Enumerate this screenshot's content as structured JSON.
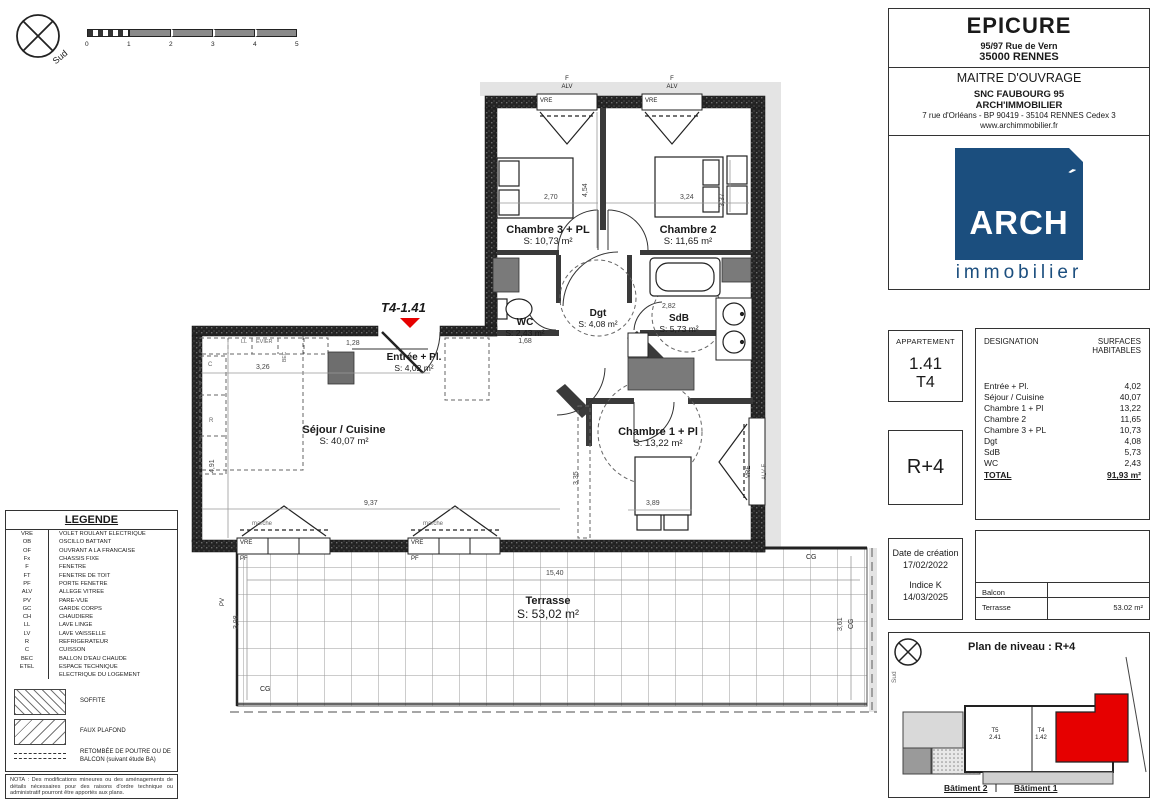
{
  "compass": {
    "label": "Sud"
  },
  "scalebar": {
    "ticks": [
      "0",
      "1",
      "2",
      "3",
      "4",
      "5"
    ]
  },
  "plan": {
    "unit_label": "T4-1.41",
    "rooms": {
      "ch3": {
        "name": "Chambre 3 + PL",
        "area": "S: 10,73 m²"
      },
      "ch2": {
        "name": "Chambre 2",
        "area": "S: 11,65 m²"
      },
      "wc": {
        "name": "WC",
        "area": "S: 2,43 m²"
      },
      "dgt": {
        "name": "Dgt",
        "area": "S: 4,08 m²"
      },
      "sdb": {
        "name": "SdB",
        "area": "S: 5,73 m²"
      },
      "entree": {
        "name": "Entrée + Pl.",
        "area": "S: 4,02 m²"
      },
      "sejour": {
        "name": "Séjour / Cuisine",
        "area": "S: 40,07 m²"
      },
      "ch1": {
        "name": "Chambre 1 + Pl",
        "area": "S: 13,22 m²"
      },
      "terrasse": {
        "name": "Terrasse",
        "area": "S: 53,02 m²"
      }
    },
    "dims": {
      "ch3_w": "2,70",
      "ch2_w": "3,24",
      "mid_h": "4,54",
      "ch2_h": "3,37",
      "entry_w": "1,28",
      "kitchen_w": "3,26",
      "sejour_h": "4,91",
      "sejour_w": "9,37",
      "wc_w": "1,68",
      "sdb_w": "2,82",
      "ch1_w": "3,89",
      "ch1_h": "3,35",
      "terr_w": "15,40",
      "terr_h": "3,98",
      "terr_r": "3,61"
    },
    "labels": {
      "f": "F",
      "alv": "ALV",
      "vre": "VRE",
      "pf": "PF",
      "pv": "PV",
      "cg": "CG",
      "marche": "marche",
      "ll": "LL",
      "evier": "EVIER",
      "c": "C",
      "r": "R",
      "bec": "BEC",
      "alv_f": "ALV  F"
    }
  },
  "title_block": {
    "project": {
      "name": "EPICURE",
      "address1": "95/97  Rue de Vern",
      "address2": "35000  RENNES"
    },
    "owner": {
      "title": "MAITRE D'OUVRAGE",
      "line1": "SNC FAUBOURG 95",
      "line2": "ARCH'IMMOBILIER",
      "line3": "7 rue d'Orléans - BP 90419 - 35104  RENNES Cedex 3",
      "line4": "www.archimmobilier.fr"
    },
    "logo": {
      "main": "ARCH",
      "accent": "´",
      "sub": "immobilier",
      "color": "#1b4e7e"
    },
    "apartment": {
      "label": "APPARTEMENT",
      "number": "1.41",
      "type": "T4"
    },
    "level": "R+4",
    "surfaces": {
      "col1": "DESIGNATION",
      "col2": "SURFACES HABITABLES",
      "rows": [
        {
          "label": "Entrée + Pl.",
          "value": "4,02"
        },
        {
          "label": "Séjour / Cuisine",
          "value": "40,07"
        },
        {
          "label": "Chambre 1 + Pl",
          "value": "13,22"
        },
        {
          "label": "Chambre 2",
          "value": "11,65"
        },
        {
          "label": "Chambre 3 + PL",
          "value": "10,73"
        },
        {
          "label": "Dgt",
          "value": "4,08"
        },
        {
          "label": "SdB",
          "value": "5,73"
        },
        {
          "label": "WC",
          "value": "2,43"
        }
      ],
      "total_label": "TOTAL",
      "total_value": "91,93 m²"
    },
    "dates": {
      "created_label": "Date de création",
      "created": "17/02/2022",
      "indice_label": "Indice K",
      "indice_date": "14/03/2025"
    },
    "exterior": {
      "balcon_label": "Balcon",
      "balcon_value": "",
      "terrasse_label": "Terrasse",
      "terrasse_value": "53.02 m²"
    }
  },
  "site_plan": {
    "title": "Plan de niveau : R+4",
    "compass_label": "Sud",
    "unit_t5": "T5",
    "unit_t5_num": "2.41",
    "unit_t4": "T4",
    "unit_t4_num": "1.42",
    "building2": "Bâtiment 2",
    "building1": "Bâtiment 1",
    "highlight_color": "#e60000"
  },
  "legend": {
    "title": "LEGENDE",
    "items": [
      {
        "abbr": "VRE",
        "label": "VOLET ROULANT ELECTRIQUE"
      },
      {
        "abbr": "OB",
        "label": "OSCILLO BATTANT"
      },
      {
        "abbr": "OF",
        "label": "OUVRANT A LA FRANCAISE"
      },
      {
        "abbr": "Fx",
        "label": "CHASSIS FIXE"
      },
      {
        "abbr": "F",
        "label": "FENETRE"
      },
      {
        "abbr": "FT",
        "label": "FENETRE DE TOIT"
      },
      {
        "abbr": "PF",
        "label": "PORTE FENETRE"
      },
      {
        "abbr": "ALV",
        "label": "ALLEGE VITREE"
      },
      {
        "abbr": "PV",
        "label": "PARE-VUE"
      },
      {
        "abbr": "GC",
        "label": "GARDE CORPS"
      },
      {
        "abbr": "CH",
        "label": "CHAUDIERE"
      },
      {
        "abbr": "LL",
        "label": "LAVE LINGE"
      },
      {
        "abbr": "LV",
        "label": "LAVE VAISSELLE"
      },
      {
        "abbr": "R",
        "label": "REFRIGERATEUR"
      },
      {
        "abbr": "C",
        "label": "CUISSON"
      },
      {
        "abbr": "BEC",
        "label": "BALLON D'EAU CHAUDE"
      },
      {
        "abbr": "ETEL",
        "label": "ESPACE TECHNIQUE"
      },
      {
        "abbr": "",
        "label": "ELECTRIQUE DU LOGEMENT"
      }
    ],
    "soffite": "SOFFITE",
    "faux_plafond": "FAUX PLAFOND",
    "retombee": "RETOMBÉE DE POUTRE OU DE BALCON",
    "retombee_note": "(suivant étude BA)",
    "nota": "NOTA : Des modifications mineures ou des aménagements de détails nécessaires pour des raisons d'ordre technique ou administratif pourront être apportés aux plans."
  }
}
